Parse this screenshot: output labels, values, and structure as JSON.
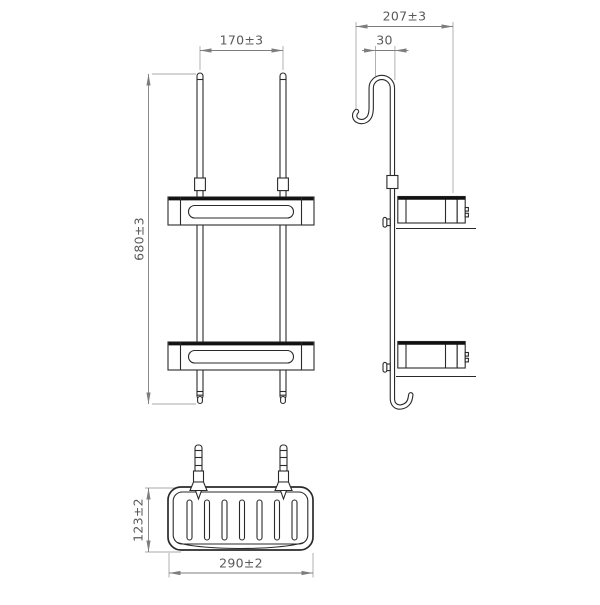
{
  "drawing": {
    "description": "Technical dimension drawing of a two-tier hanging shower basket shown in front view, side view and plan view",
    "views": {
      "front_view": {
        "dimensions": [
          {
            "id": "rod_spacing",
            "value": "170±3"
          },
          {
            "id": "overall_height",
            "value": "680±3"
          }
        ]
      },
      "side_view": {
        "dimensions": [
          {
            "id": "overall_depth",
            "value": "207±3"
          },
          {
            "id": "hook_opening",
            "value": "30"
          }
        ]
      },
      "plan_view": {
        "dimensions": [
          {
            "id": "basket_width",
            "value": "290±2"
          },
          {
            "id": "basket_depth",
            "value": "123±2"
          }
        ]
      }
    },
    "colors": {
      "outline": "#2a2a2a",
      "thick_edge": "#111111",
      "dimension_lines": "#7d7d7d",
      "extension_lines": "#a9a9a9",
      "dimension_text": "#5a5a5a",
      "background": "#ffffff"
    }
  }
}
